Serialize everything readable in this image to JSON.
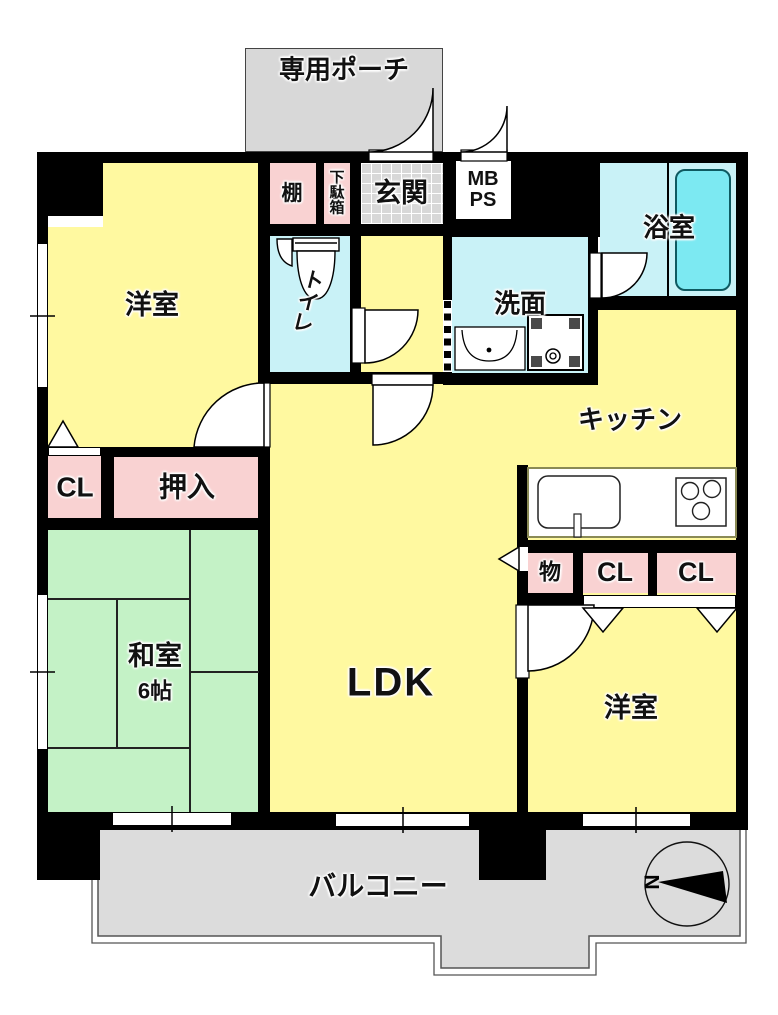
{
  "plan": {
    "rooms": {
      "porch": "専用ポーチ",
      "shelf": "棚",
      "shoe_cabinet": "下\n駄\n箱",
      "entrance": "玄関",
      "meter_box": "MB\nPS",
      "bathroom": "浴室",
      "washroom": "洗面",
      "toilet": "ト\nイ\nレ",
      "western_room_1": "洋室",
      "closet_1": "CL",
      "oshiire": "押入",
      "japanese_room": "和室",
      "japanese_room_size": "6帖",
      "ldk": "LDK",
      "kitchen": "キッチン",
      "storage": "物",
      "closet_2": "CL",
      "closet_3": "CL",
      "western_room_2": "洋室",
      "balcony": "バルコニー"
    },
    "compass": {
      "north_label": "N"
    },
    "colors": {
      "wall": "#000000",
      "room": "#FFF9A0",
      "tatami": "#C4F2C6",
      "wet": "#C9F2F7",
      "tub": "#7CE9F2",
      "closet": "#F9D2D2",
      "porch": "#D8D8D8",
      "balcony": "#DCDCDC"
    }
  }
}
